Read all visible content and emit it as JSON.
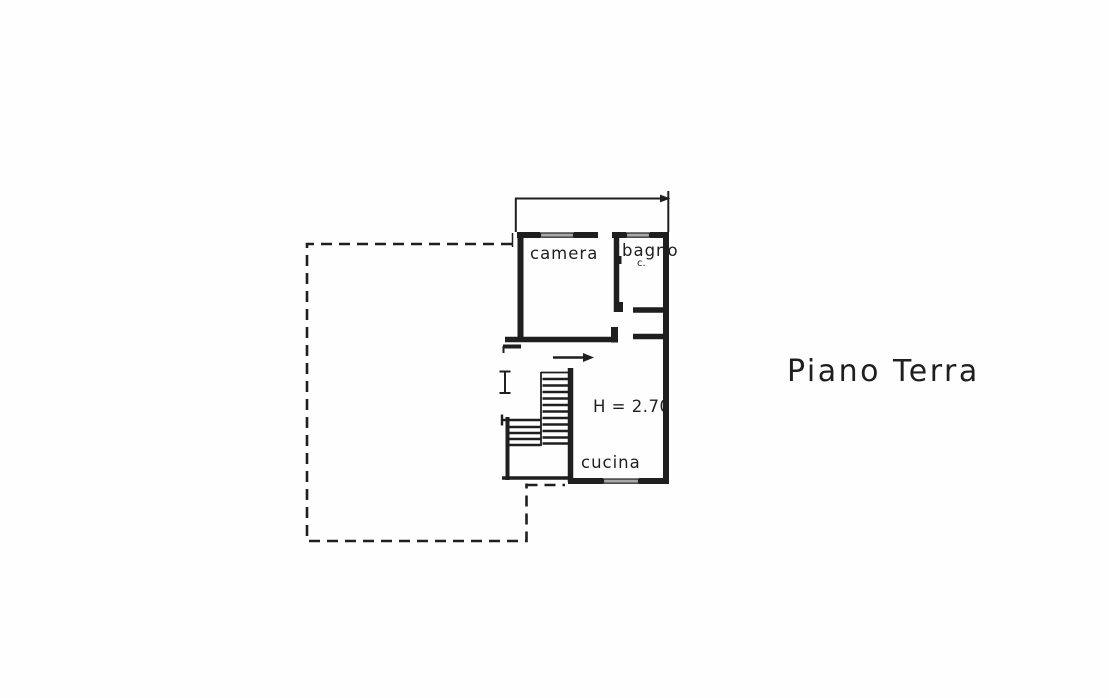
{
  "colors": {
    "paper": "#fefefe",
    "ink": "#1f1f1f",
    "window_fill": "#a9a9a9"
  },
  "title": {
    "text": "Piano Terra"
  },
  "rooms": {
    "camera": {
      "label": "camera"
    },
    "bagno": {
      "label": "bagno",
      "abbrev": "c."
    },
    "cucina": {
      "label": "cucina"
    }
  },
  "annotations": {
    "ceiling_height": "H = 2.70"
  }
}
